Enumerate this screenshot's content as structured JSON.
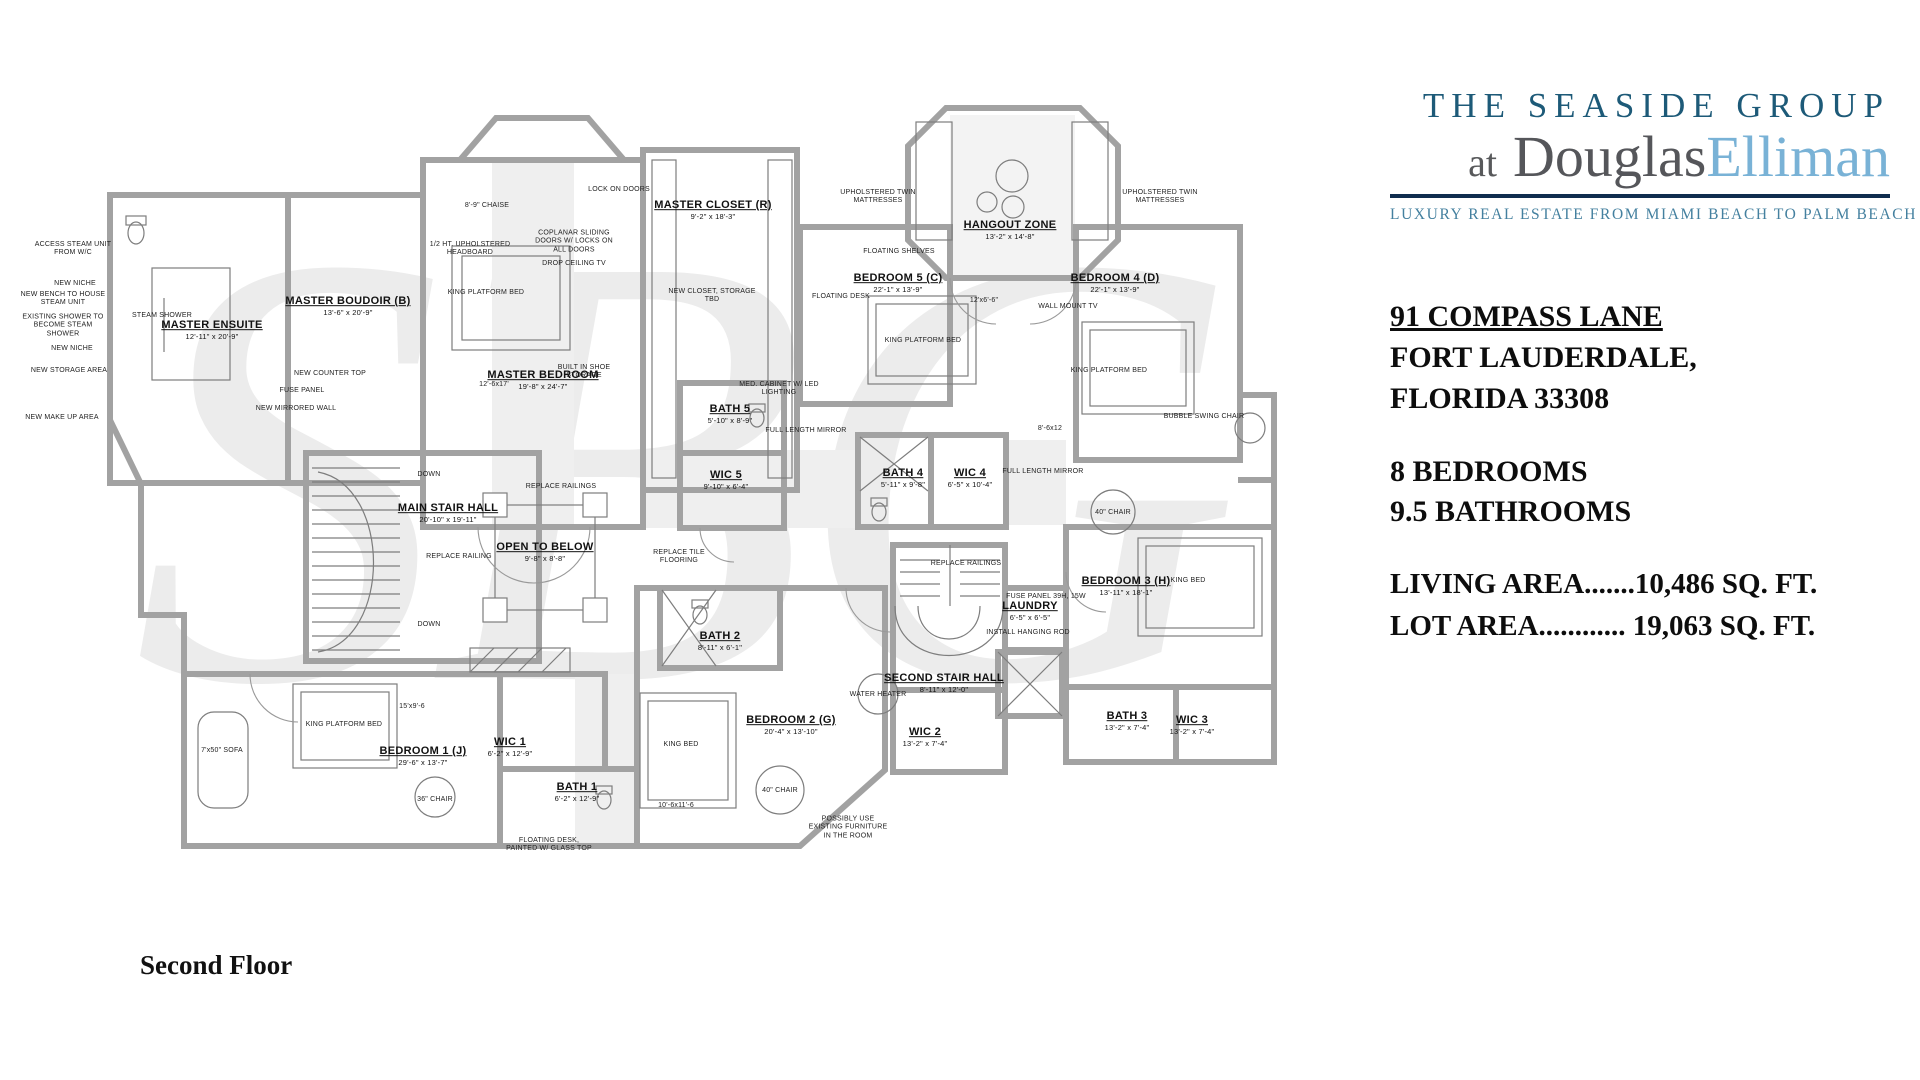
{
  "branding": {
    "line1": "THE SEASIDE GROUP",
    "line2_prefix": "at ",
    "line2_douglas": "Douglas",
    "line2_elliman": "Elliman",
    "tagline": "LUXURY REAL ESTATE FROM MIAMI BEACH TO PALM BEACH",
    "colors": {
      "group_blue": "#1d5a78",
      "elliman_blue": "#79b2d6",
      "rule_navy": "#0f2d4e",
      "tagline_blue": "#44809f"
    }
  },
  "listing": {
    "address_line1": "91 COMPASS LANE",
    "address_line2": "FORT LAUDERDALE,",
    "address_line3": "FLORIDA 33308",
    "bedrooms": "8 BEDROOMS",
    "bathrooms": "9.5 BATHROOMS",
    "living_area": "LIVING AREA.......10,486 SQ. FT.",
    "lot_area": "LOT AREA............ 19,063 SQ. FT."
  },
  "floor_label": "Second Floor",
  "watermark": "SBG",
  "plan": {
    "rooms": [
      {
        "name": "MASTER ENSUITE",
        "dims": "12'-11\" x 20'-9\"",
        "x": 212,
        "y": 330
      },
      {
        "name": "MASTER BOUDOIR (B)",
        "dims": "13'-6\" x 20'-9\"",
        "x": 348,
        "y": 306
      },
      {
        "name": "MASTER BEDROOM",
        "dims": "19'-8\" x 24'-7\"",
        "x": 543,
        "y": 380
      },
      {
        "name": "MASTER CLOSET (R)",
        "dims": "9'-2\" x 18'-3\"",
        "x": 713,
        "y": 210
      },
      {
        "name": "BATH 5",
        "dims": "5'-10\" x 8'-9\"",
        "x": 730,
        "y": 414
      },
      {
        "name": "WIC 5",
        "dims": "9'-10\" x 6'-4\"",
        "x": 726,
        "y": 480
      },
      {
        "name": "BEDROOM 5  (C)",
        "dims": "22'-1\" x 13'-9\"",
        "x": 898,
        "y": 283
      },
      {
        "name": "HANGOUT ZONE",
        "dims": "13'-2\" x 14'-8\"",
        "x": 1010,
        "y": 230
      },
      {
        "name": "BEDROOM 4  (D)",
        "dims": "22'-1\" x 13'-9\"",
        "x": 1115,
        "y": 283
      },
      {
        "name": "BATH 4",
        "dims": "5'-11\" x 9'-8\"",
        "x": 903,
        "y": 478
      },
      {
        "name": "WIC 4",
        "dims": "6'-5\" x 10'-4\"",
        "x": 970,
        "y": 478
      },
      {
        "name": "MAIN STAIR HALL",
        "dims": "20'-10\" x 19'-11\"",
        "x": 448,
        "y": 513
      },
      {
        "name": "OPEN TO BELOW",
        "dims": "9'-8\" x 8'-8\"",
        "x": 545,
        "y": 552
      },
      {
        "name": "BEDROOM 3 (H)",
        "dims": "13'-11\" x 18'-1\"",
        "x": 1126,
        "y": 586
      },
      {
        "name": "LAUNDRY",
        "dims": "6'-5\" x 6'-5\"",
        "x": 1030,
        "y": 611
      },
      {
        "name": "SECOND STAIR HALL",
        "dims": "8'-11\" x 12'-0\"",
        "x": 944,
        "y": 683
      },
      {
        "name": "WIC 2",
        "dims": "13'-2\" x 7'-4\"",
        "x": 925,
        "y": 737
      },
      {
        "name": "BATH 3",
        "dims": "13'-2\" x 7'-4\"",
        "x": 1127,
        "y": 721
      },
      {
        "name": "WIC 3",
        "dims": "13'-2\" x 7'-4\"",
        "x": 1192,
        "y": 725
      },
      {
        "name": "BEDROOM 2  (G)",
        "dims": "20'-4\" x 13'-10\"",
        "x": 791,
        "y": 725
      },
      {
        "name": "BATH 2",
        "dims": "8'-11\" x 6'-1\"",
        "x": 720,
        "y": 641
      },
      {
        "name": "BEDROOM 1  (J)",
        "dims": "29'-6\" x 13'-7\"",
        "x": 423,
        "y": 756
      },
      {
        "name": "WIC 1",
        "dims": "6'-2\" x 12'-9\"",
        "x": 510,
        "y": 747
      },
      {
        "name": "BATH 1",
        "dims": "6'-2\" x 12'-9\"",
        "x": 577,
        "y": 792
      }
    ],
    "annotations": [
      {
        "text": "ACCESS STEAM UNIT FROM W/C",
        "x": 73,
        "y": 249
      },
      {
        "text": "NEW NICHE",
        "x": 75,
        "y": 284
      },
      {
        "text": "NEW BENCH TO HOUSE STEAM UNIT",
        "x": 63,
        "y": 299
      },
      {
        "text": "EXISTING SHOWER TO BECOME STEAM SHOWER",
        "x": 63,
        "y": 326
      },
      {
        "text": "NEW NICHE",
        "x": 72,
        "y": 349
      },
      {
        "text": "NEW STORAGE AREA",
        "x": 69,
        "y": 371
      },
      {
        "text": "NEW MAKE UP AREA",
        "x": 62,
        "y": 418
      },
      {
        "text": "STEAM SHOWER",
        "x": 162,
        "y": 316
      },
      {
        "text": "NEW COUNTER TOP",
        "x": 330,
        "y": 374
      },
      {
        "text": "FUSE PANEL",
        "x": 302,
        "y": 391
      },
      {
        "text": "NEW MIRRORED WALL",
        "x": 296,
        "y": 409
      },
      {
        "text": "8'-9\" CHAISE",
        "x": 487,
        "y": 206
      },
      {
        "text": "LOCK ON DOORS",
        "x": 619,
        "y": 190
      },
      {
        "text": "1/2 HT. UPHOLSTERED HEADBOARD",
        "x": 470,
        "y": 249
      },
      {
        "text": "COPLANAR SLIDING DOORS W/ LOCKS ON ALL DOORS",
        "x": 574,
        "y": 242
      },
      {
        "text": "DROP CEILING TV",
        "x": 574,
        "y": 264
      },
      {
        "text": "KING PLATFORM BED",
        "x": 486,
        "y": 293
      },
      {
        "text": "12'-6x17'",
        "x": 494,
        "y": 385
      },
      {
        "text": "BUILT IN SHOE STORAGE",
        "x": 584,
        "y": 372
      },
      {
        "text": "NEW CLOSET, STORAGE TBD",
        "x": 712,
        "y": 296
      },
      {
        "text": "MED. CABINET W/ LED LIGHTING",
        "x": 779,
        "y": 389
      },
      {
        "text": "FULL LENGTH MIRROR",
        "x": 806,
        "y": 431
      },
      {
        "text": "UPHOLSTERED TWIN MATTRESSES",
        "x": 878,
        "y": 197
      },
      {
        "text": "UPHOLSTERED TWIN MATTRESSES",
        "x": 1160,
        "y": 197
      },
      {
        "text": "FLOATING SHELVES",
        "x": 899,
        "y": 252
      },
      {
        "text": "FLOATING DESK",
        "x": 841,
        "y": 297
      },
      {
        "text": "KING PLATFORM BED",
        "x": 923,
        "y": 341
      },
      {
        "text": "12'x6'-6\"",
        "x": 984,
        "y": 301
      },
      {
        "text": "WALL MOUNT TV",
        "x": 1068,
        "y": 307
      },
      {
        "text": "KING PLATFORM BED",
        "x": 1109,
        "y": 371
      },
      {
        "text": "8'-6x12",
        "x": 1050,
        "y": 429
      },
      {
        "text": "BUBBLE SWING CHAIR",
        "x": 1204,
        "y": 417
      },
      {
        "text": "FULL LENGTH MIRROR",
        "x": 1043,
        "y": 472
      },
      {
        "text": "DOWN",
        "x": 429,
        "y": 475
      },
      {
        "text": "DOWN",
        "x": 429,
        "y": 625
      },
      {
        "text": "REPLACE RAILINGS",
        "x": 561,
        "y": 487
      },
      {
        "text": "REPLACE RAILING",
        "x": 459,
        "y": 557
      },
      {
        "text": "REPLACE TILE FLOORING",
        "x": 679,
        "y": 557
      },
      {
        "text": "REPLACE RAILINGS",
        "x": 966,
        "y": 564
      },
      {
        "text": "FUSE PANEL 39H, 15W",
        "x": 1046,
        "y": 597
      },
      {
        "text": "INSTALL HANGING ROD",
        "x": 1028,
        "y": 633
      },
      {
        "text": "KING BED",
        "x": 1188,
        "y": 581
      },
      {
        "text": "40\" CHAIR",
        "x": 1113,
        "y": 513
      },
      {
        "text": "WATER HEATER",
        "x": 878,
        "y": 695
      },
      {
        "text": "KING BED",
        "x": 681,
        "y": 745
      },
      {
        "text": "40\" CHAIR",
        "x": 780,
        "y": 791
      },
      {
        "text": "10'-6x11'-6",
        "x": 676,
        "y": 806
      },
      {
        "text": "POSSIBLY USE EXISTING FURNITURE IN THE ROOM",
        "x": 848,
        "y": 828
      },
      {
        "text": "7'x50\" SOFA",
        "x": 222,
        "y": 751
      },
      {
        "text": "KING PLATFORM BED",
        "x": 344,
        "y": 725
      },
      {
        "text": "15'x9'-6",
        "x": 412,
        "y": 707
      },
      {
        "text": "36\" CHAIR",
        "x": 435,
        "y": 800
      },
      {
        "text": "FLOATING DESK, PAINTED W/ GLASS TOP",
        "x": 549,
        "y": 845
      }
    ]
  }
}
